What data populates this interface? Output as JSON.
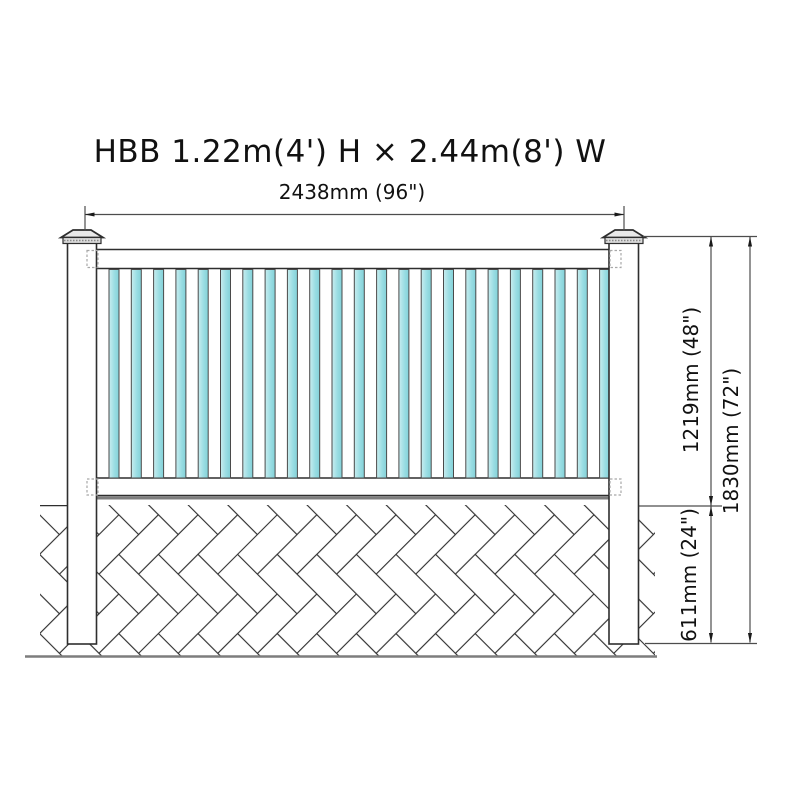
{
  "title": "HBB 1.22m(4') H × 2.44m(8') W",
  "dimensions": {
    "width_label": "2438mm (96\")",
    "panel_height_label": "1219mm (48\")",
    "total_height_label": "1830mm (72\")",
    "buried_depth_label": "611mm (24\")"
  },
  "fence": {
    "picket_count": 23,
    "post_count": 2,
    "rail_count": 2
  },
  "colors": {
    "picket_edge": "#83d1d8",
    "picket_mid": "#9adde3",
    "picket_light": "#c9edef",
    "outline": "#2e2e2e",
    "dim_line": "#4d4d4d",
    "arrow": "#1a1a1a",
    "ground_gray": "#7d7d7d",
    "dashed_connector": "#a8a8a8",
    "cap_fill": "#e9e9e9",
    "collar_fill": "#dcdcdc"
  }
}
